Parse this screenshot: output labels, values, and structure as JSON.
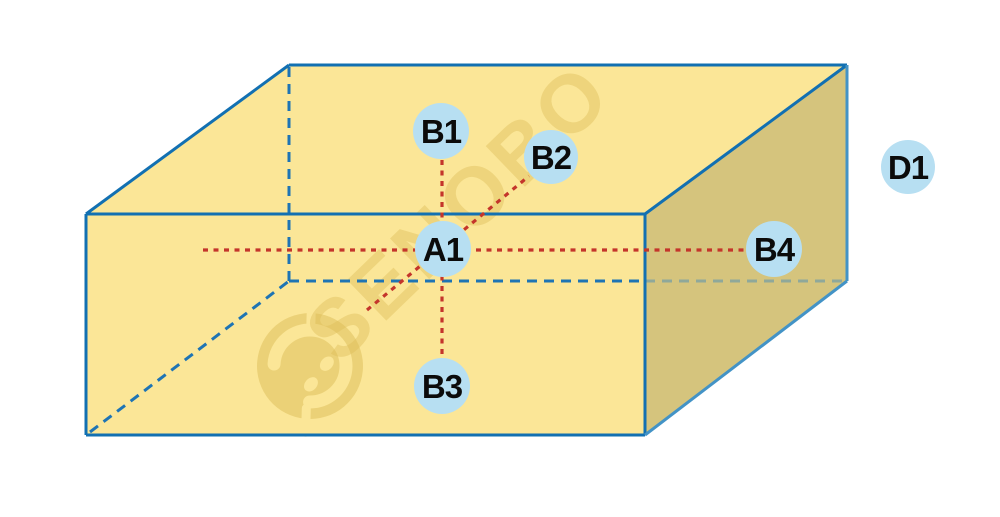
{
  "figure": {
    "kind": "3d-box-point-diagram",
    "width": 1000,
    "height": 517,
    "colors": {
      "background": "#FFFFFF",
      "face_light": "#FBE697",
      "face_dark": "#D5C47D",
      "edge": "#1270B2",
      "edge_light": "#4393C6",
      "edge_hidden": "#1E74B4",
      "edge_hidden_ghost": "#8FA89A",
      "guide": "#C4352B",
      "node_fill": "#B7DFF2",
      "node_text": "#0B0B0B",
      "watermark": "#DDBD58"
    },
    "watermark": {
      "text": "SENOBO",
      "text_x": 478,
      "text_y": 232,
      "angle": -44,
      "font_size": 82,
      "text_opacity": 0.42,
      "logo_x": 310,
      "logo_y": 366,
      "logo_angle": -40,
      "logo_opacity": 0.5
    },
    "faces": [
      {
        "name": "box-top-face",
        "points": "86,214 289,65 847,65 645,214",
        "fill": "face_light"
      },
      {
        "name": "box-front-face",
        "points": "86,214 645,214 645,435 86,435",
        "fill": "face_light"
      },
      {
        "name": "box-right-face",
        "points": "645,214 847,65 847,281 645,435",
        "fill": "face_dark"
      }
    ],
    "edges": [
      {
        "name": "edge-hidden-vertical",
        "x1": 289,
        "y1": 67,
        "x2": 289,
        "y2": 281,
        "style": "hidden"
      },
      {
        "name": "edge-hidden-left",
        "x1": 90,
        "y1": 432,
        "x2": 289,
        "y2": 281,
        "style": "hidden"
      },
      {
        "name": "edge-hidden-back-front",
        "x1": 289,
        "y1": 281,
        "x2": 645,
        "y2": 281,
        "style": "hidden"
      },
      {
        "name": "edge-hidden-back-right",
        "x1": 645,
        "y1": 281,
        "x2": 845,
        "y2": 281,
        "style": "ghost"
      },
      {
        "name": "edge-front-top",
        "x1": 86,
        "y1": 214,
        "x2": 645,
        "y2": 214,
        "style": "solid"
      },
      {
        "name": "edge-front-bottom",
        "x1": 86,
        "y1": 435,
        "x2": 645,
        "y2": 435,
        "style": "solid"
      },
      {
        "name": "edge-front-left",
        "x1": 86,
        "y1": 214,
        "x2": 86,
        "y2": 435,
        "style": "solid"
      },
      {
        "name": "edge-front-right",
        "x1": 645,
        "y1": 214,
        "x2": 645,
        "y2": 435,
        "style": "solid"
      },
      {
        "name": "edge-top-left",
        "x1": 86,
        "y1": 214,
        "x2": 289,
        "y2": 65,
        "style": "solid"
      },
      {
        "name": "edge-top-back",
        "x1": 289,
        "y1": 65,
        "x2": 847,
        "y2": 65,
        "style": "solid"
      },
      {
        "name": "edge-top-right",
        "x1": 847,
        "y1": 65,
        "x2": 645,
        "y2": 214,
        "style": "solid"
      },
      {
        "name": "edge-right-back",
        "x1": 847,
        "y1": 65,
        "x2": 847,
        "y2": 281,
        "style": "light"
      },
      {
        "name": "edge-right-bottom",
        "x1": 847,
        "y1": 281,
        "x2": 645,
        "y2": 435,
        "style": "light"
      }
    ],
    "guides": [
      {
        "name": "guide-horizontal-A1-B4",
        "x1": 203,
        "y1": 250,
        "x2": 746,
        "y2": 250
      },
      {
        "name": "guide-vertical-B1-B3",
        "x1": 442,
        "y1": 160,
        "x2": 442,
        "y2": 357
      },
      {
        "name": "guide-diagonal-A1-B2",
        "x1": 367,
        "y1": 310,
        "x2": 529,
        "y2": 176
      }
    ],
    "nodes": [
      {
        "id": "A1",
        "label": "A1",
        "x": 443,
        "y": 249,
        "r": 28
      },
      {
        "id": "B1",
        "label": "B1",
        "x": 441,
        "y": 131,
        "r": 28
      },
      {
        "id": "B2",
        "label": "B2",
        "x": 551,
        "y": 157,
        "r": 27
      },
      {
        "id": "B3",
        "label": "B3",
        "x": 442,
        "y": 386,
        "r": 28
      },
      {
        "id": "B4",
        "label": "B4",
        "x": 774,
        "y": 249,
        "r": 28
      },
      {
        "id": "D1",
        "label": "D1",
        "x": 908,
        "y": 167,
        "r": 27
      }
    ]
  }
}
